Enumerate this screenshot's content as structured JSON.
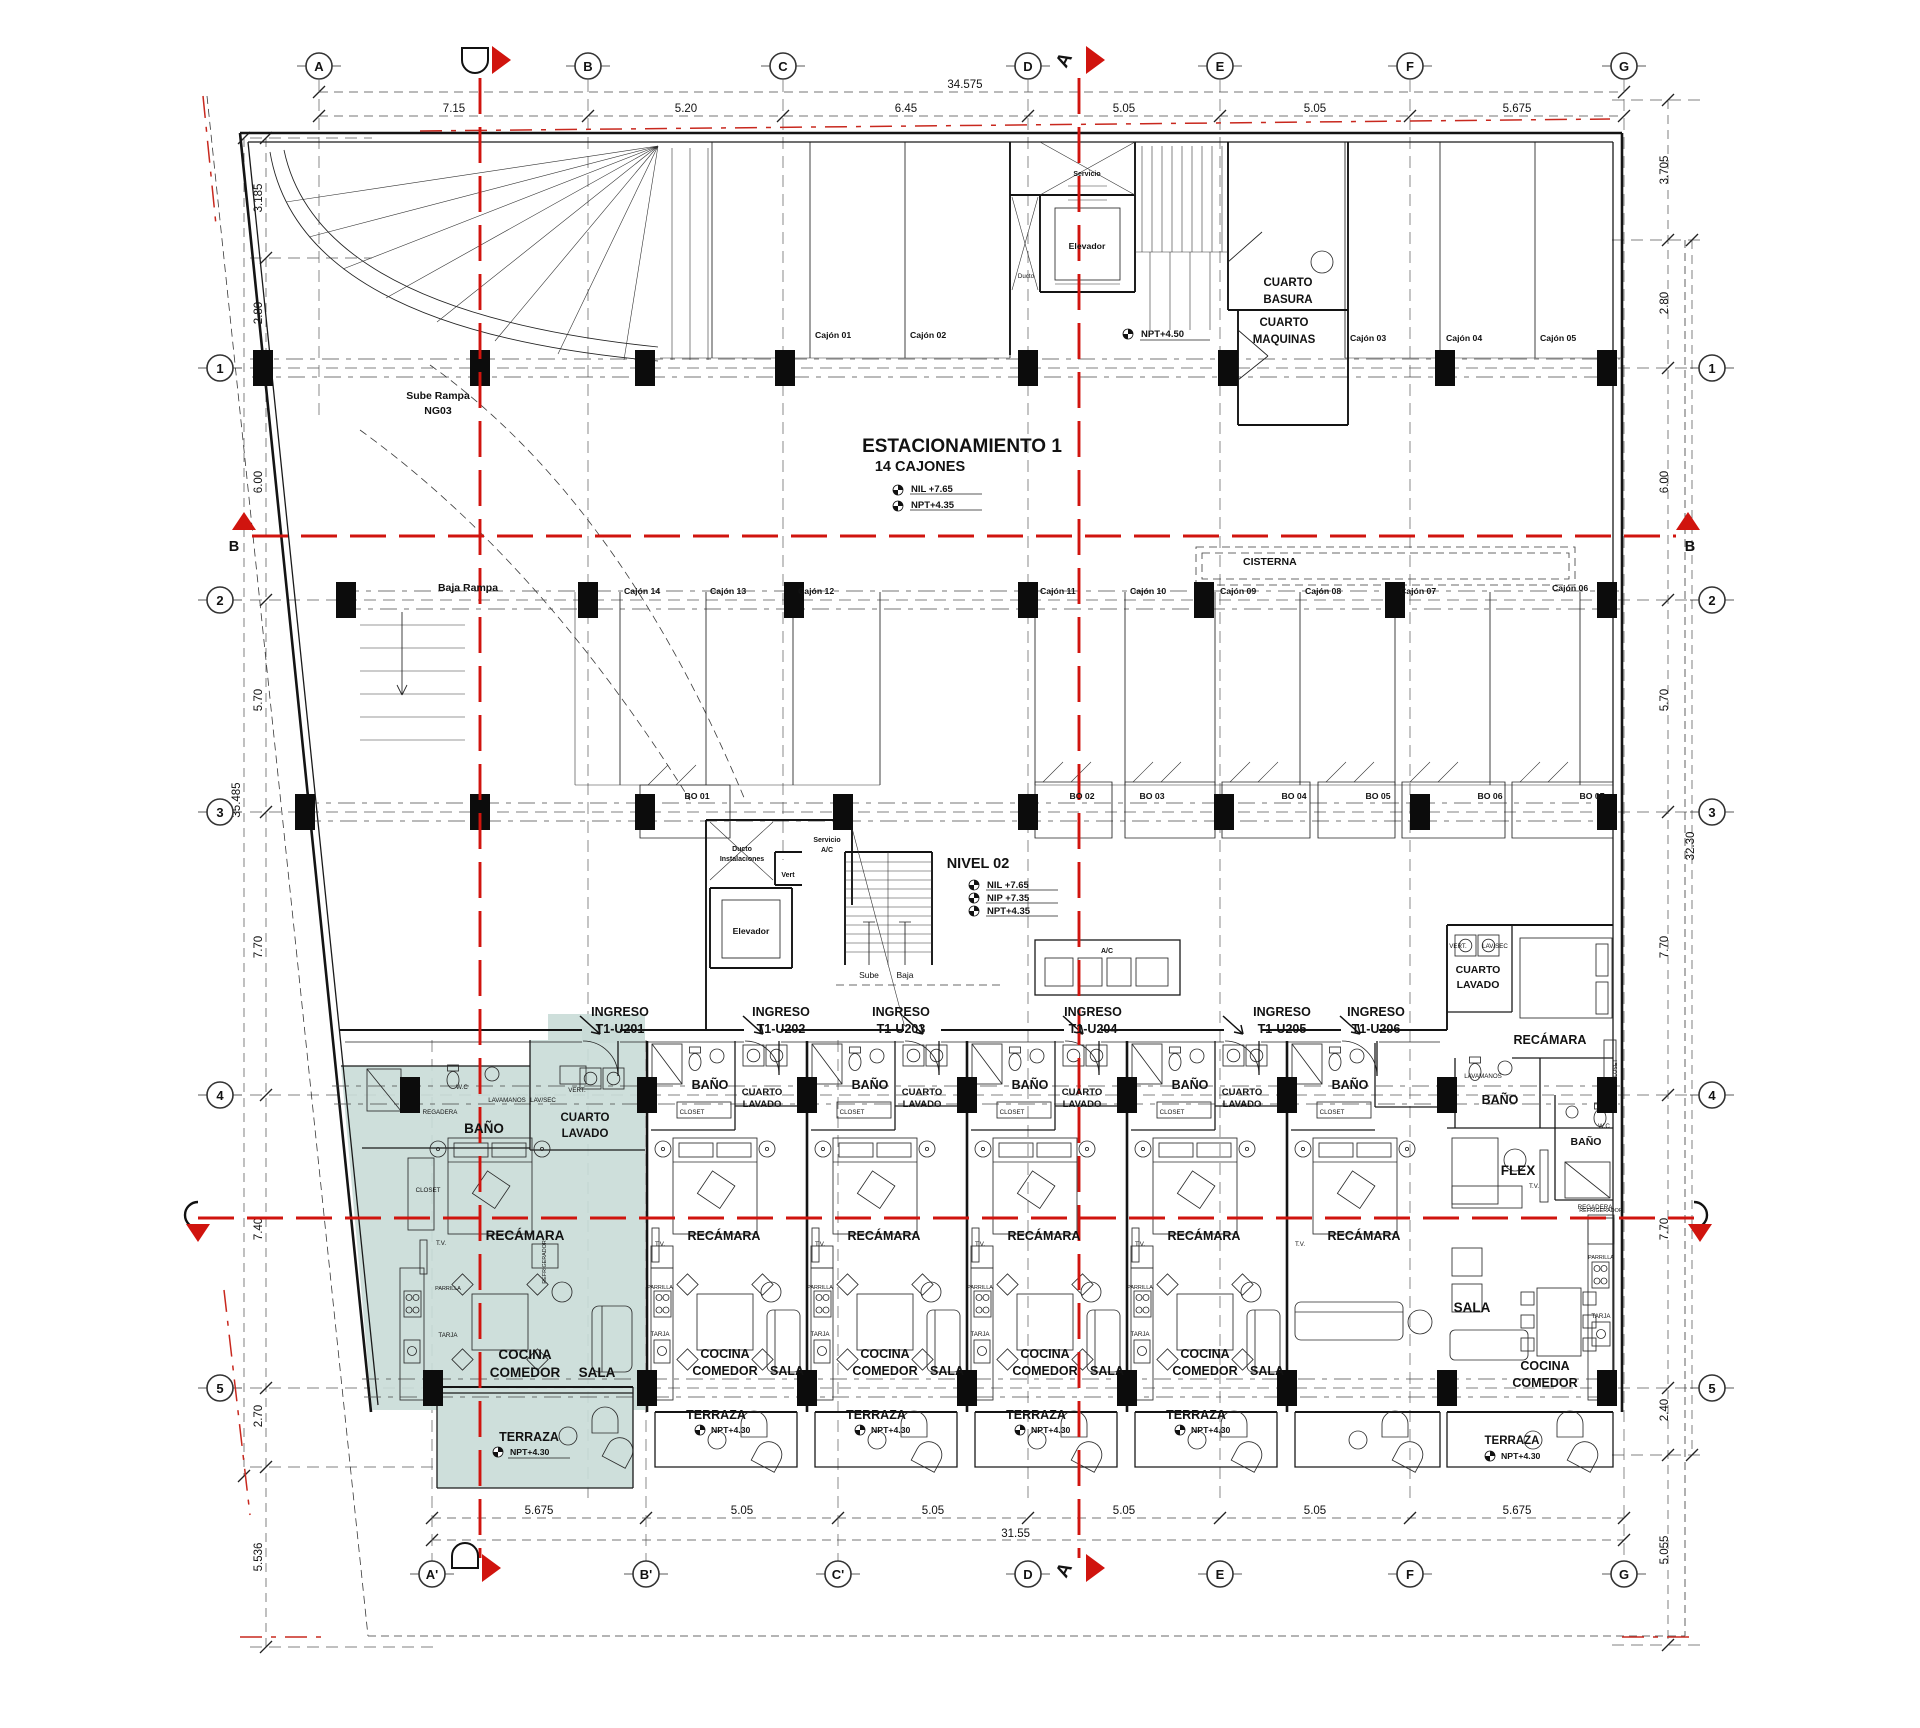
{
  "axes": {
    "top": [
      "A",
      "B",
      "C",
      "D",
      "E",
      "F",
      "G"
    ],
    "bottom": [
      "A'",
      "B'",
      "C'",
      "D",
      "E",
      "F",
      "G"
    ],
    "left": [
      "1",
      "2",
      "3",
      "4",
      "5"
    ],
    "right": [
      "1",
      "2",
      "3",
      "4",
      "5"
    ]
  },
  "sections": {
    "a": "A",
    "b": "B"
  },
  "dims": {
    "top_overall": "34.575",
    "top": [
      "7.15",
      "5.20",
      "6.45",
      "5.05",
      "5.05",
      "5.675"
    ],
    "bottom_overall": "31.55",
    "bottom": [
      "5.675",
      "5.05",
      "5.05",
      "5.05",
      "5.05",
      "5.675"
    ],
    "left": [
      "3.185",
      "2.80",
      "6.00",
      "5.70",
      "7.70",
      "7.40",
      "2.70"
    ],
    "left_overall": "35.485",
    "left_offset": "5.536",
    "right": [
      "3.705",
      "2.80",
      "6.00",
      "5.70",
      "7.70",
      "7.70",
      "2.40"
    ],
    "right_overall": "32.30",
    "right_offset": "5.055"
  },
  "parking": {
    "title": "ESTACIONAMIENTO 1",
    "subtitle": "14 CAJONES",
    "nil": "NIL +7.65",
    "npt": "NPT+4.35",
    "npt_entry": "NPT+4.50",
    "sube_rampa": "Sube Rampa",
    "rampa_code": "NG03",
    "baja_rampa": "Baja Rampa",
    "cisterna": "CISTERNA",
    "stalls": [
      "Cajón 01",
      "Cajón 02",
      "Cajón 03",
      "Cajón 04",
      "Cajón 05",
      "Cajón 06",
      "Cajón 07",
      "Cajón 08",
      "Cajón 09",
      "Cajón 10",
      "Cajón 11",
      "Cajón 12",
      "Cajón 13",
      "Cajón 14"
    ]
  },
  "storage": [
    "BO 01",
    "BO 02",
    "BO 03",
    "BO 04",
    "BO 05",
    "BO 06",
    "BO 07"
  ],
  "core_top": {
    "servicio": "Servicio",
    "elevador": "Elevador",
    "ducto": "Ducto",
    "basura1": "CUARTO",
    "basura2": "BASURA",
    "maquinas1": "CUARTO",
    "maquinas2": "MAQUINAS"
  },
  "core_mid": {
    "ducto1": "Ducto",
    "ducto2": "Instalaciones",
    "vert": "Vert",
    "serv1": "Servicio",
    "serv2": "A/C",
    "elevador": "Elevador",
    "sube": "Sube",
    "baja": "Baja",
    "ac": "A/C",
    "nivel": "NIVEL 02",
    "nil": "NIL +7.65",
    "nip": "NIP +7.35",
    "npt": "NPT+4.35"
  },
  "units": {
    "ingreso": "INGRESO",
    "codes": [
      "T1-U201",
      "T1-U202",
      "T1-U203",
      "T1-U204",
      "T1-U205",
      "T1-U206"
    ]
  },
  "rooms": {
    "bano": "BAÑO",
    "cuarto": "CUARTO",
    "lavado": "LAVADO",
    "recamara": "RECÁMARA",
    "cocina": "COCINA",
    "comedor": "COMEDOR",
    "sala": "SALA",
    "terraza": "TERRAZA",
    "flex": "FLEX",
    "npt430": "NPT+4.30"
  },
  "fix": {
    "wc": "W.C",
    "lavamanos": "LAVAMANOS",
    "lavsec": "LAV/SEC",
    "regadera": "REGADERA",
    "vert": "VERT.",
    "closet": "CLOSET",
    "tv": "T.V.",
    "tarja": "TARJA",
    "parrilla": "PARRILLA",
    "refrigerador": "REFRIGERADOR"
  },
  "colors": {
    "highlight": "#c9dbd7",
    "axis_red": "#d0140e"
  }
}
